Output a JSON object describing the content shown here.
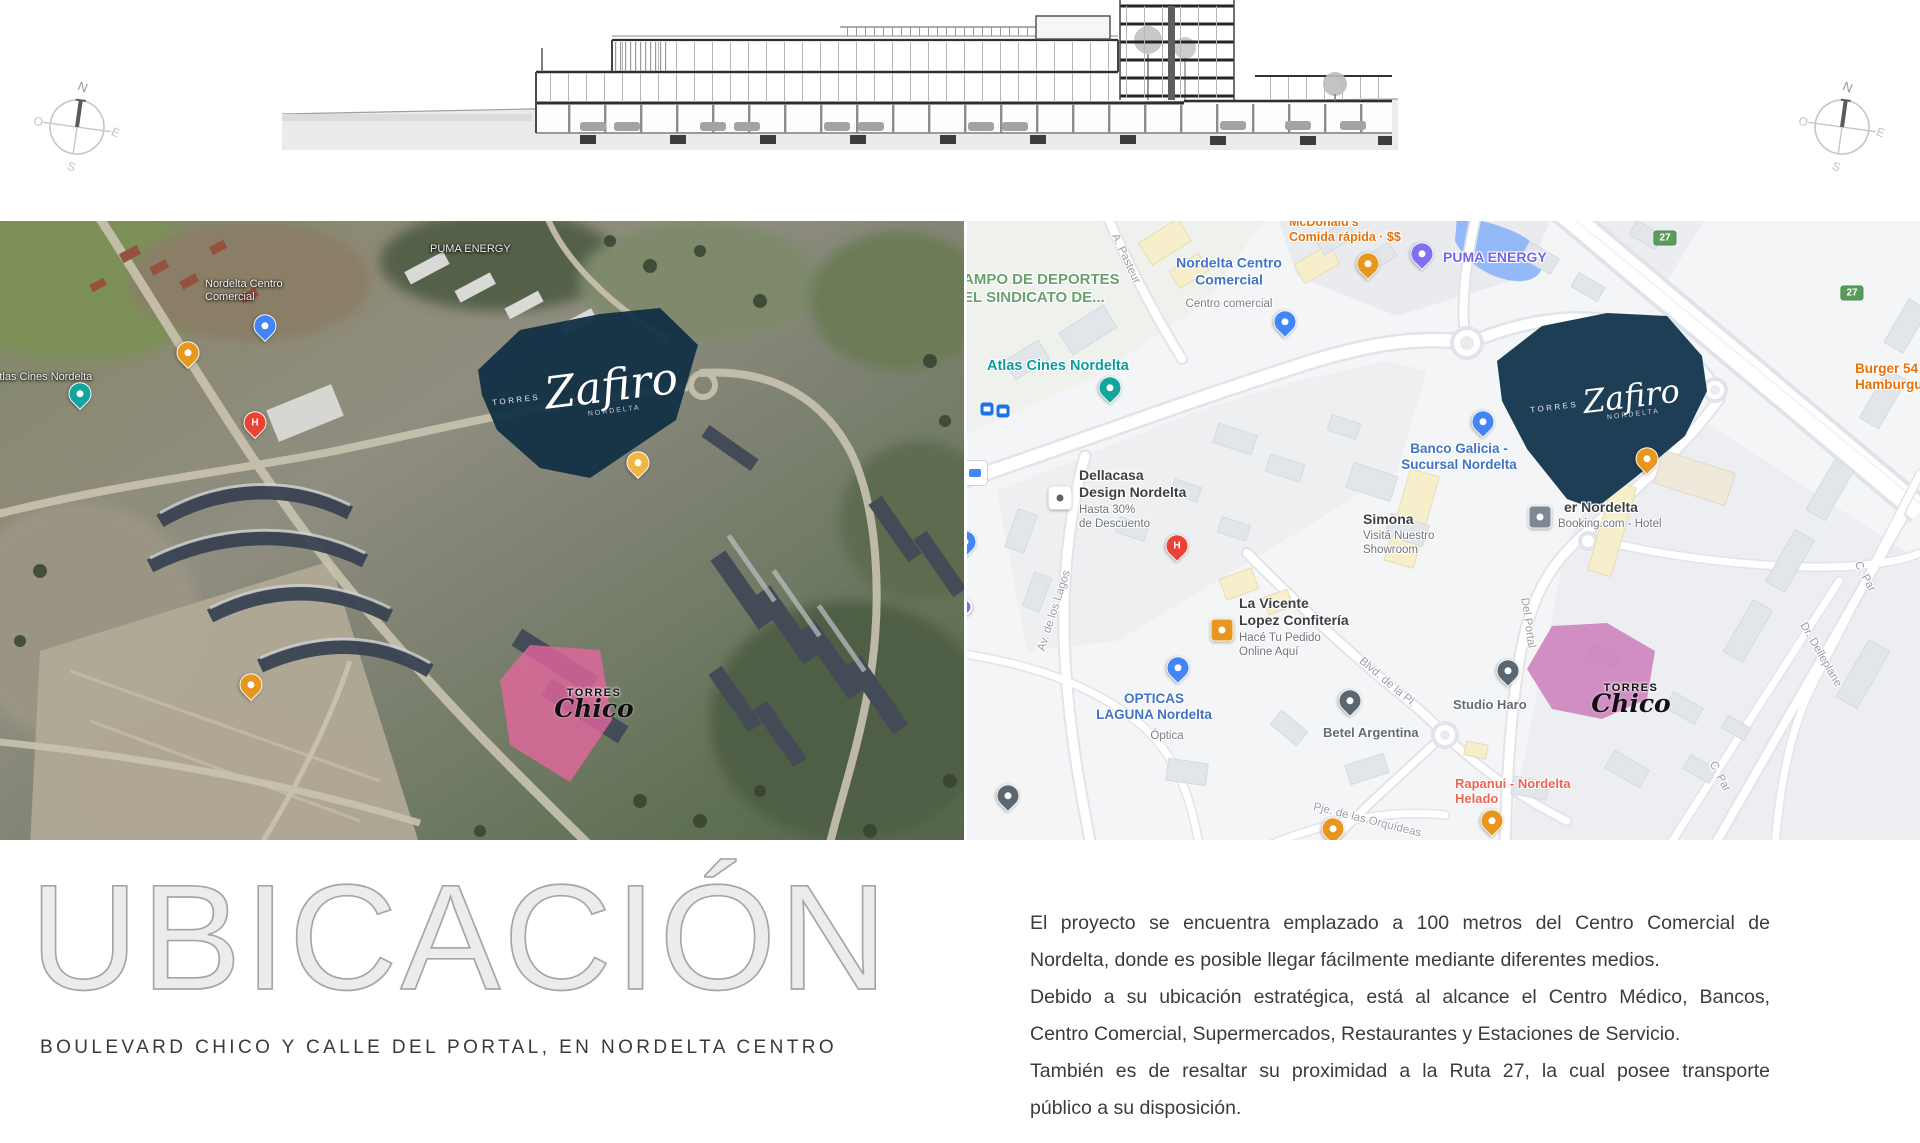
{
  "slide": {
    "title": "UBICACIÓN",
    "subtitle": "BOULEVARD CHICO Y CALLE DEL PORTAL, EN NORDELTA CENTRO",
    "paragraph_lines": [
      "El proyecto se encuentra emplazado a 100 metros del Centro Comercial de",
      "Nordelta, donde es posible llegar fácilmente mediante diferentes medios.",
      "Debido a su ubicación estratégica, está al alcance el Centro Médico, Bancos,",
      "Centro Comercial, Supermercados, Restaurantes y Estaciones de Servicio.",
      "También es de resaltar su proximidad a la Ruta 27, la cual posee transporte",
      "público a su disposición."
    ],
    "paragraph_justify": [
      true,
      false,
      true,
      false,
      true,
      false
    ]
  },
  "compass": {
    "n": "N",
    "e": "E",
    "s": "S",
    "o": "O"
  },
  "logos": {
    "zafiro": {
      "pre": "TORRES",
      "script": "Zafiro",
      "sub": "NORDELTA"
    },
    "torres": {
      "caps": "TORRES",
      "script": "Chico"
    }
  },
  "street_map": {
    "shields": [
      {
        "label": "27",
        "x": 698,
        "y": 17
      },
      {
        "label": "27",
        "x": 885,
        "y": 72
      }
    ],
    "labels": [
      {
        "lines": [
          "AMPO DE DEPORTES",
          "EL SINDICATO DE..."
        ],
        "x": -4,
        "y": 50,
        "size": 15,
        "w": 700,
        "color": "#68a06e"
      },
      {
        "lines": [
          "Atlas Cines Nordelta"
        ],
        "x": 20,
        "y": 137,
        "size": 14.5,
        "w": 700,
        "color": "#0d9c9c"
      },
      {
        "lines": [
          "Nordelta Centro",
          "Comercial"
        ],
        "x": 262,
        "y": 50,
        "c": true,
        "size": 14,
        "w": 700,
        "color": "#4273c4"
      },
      {
        "lines": [
          "Centro comercial"
        ],
        "x": 262,
        "y": 84,
        "c": true,
        "size": 11.5,
        "w": 400,
        "color": "#7c8187"
      },
      {
        "lines": [
          "McDonald's",
          "Comida rápida · $$"
        ],
        "x": 322,
        "y": -6,
        "size": 12.5,
        "w": 700,
        "color": "#e8710a"
      },
      {
        "lines": [
          "PUMA ENERGY"
        ],
        "x": 476,
        "y": 28,
        "size": 14,
        "w": 700,
        "color": "#7265e8"
      },
      {
        "lines": [
          "Banco Galicia -",
          "Sucursal Nordelta"
        ],
        "x": 492,
        "y": 236,
        "c": true,
        "size": 13.5,
        "w": 600,
        "color": "#4273c4"
      },
      {
        "lines": [
          "Simona"
        ],
        "x": 396,
        "y": 290,
        "size": 14,
        "w": 700,
        "color": "#3c4043"
      },
      {
        "lines": [
          "Visitá Nuestro",
          "Showroom"
        ],
        "x": 396,
        "y": 309,
        "size": 11.5,
        "w": 400,
        "color": "#70757a"
      },
      {
        "lines": [
          "er Nordelta"
        ],
        "x": 597,
        "y": 278,
        "size": 14,
        "w": 700,
        "color": "#3c4043"
      },
      {
        "lines": [
          "Booking.com - Hotel"
        ],
        "x": 591,
        "y": 297,
        "size": 11.5,
        "w": 400,
        "color": "#70757a"
      },
      {
        "lines": [
          "Dellacasa",
          "Design Nordelta"
        ],
        "x": 112,
        "y": 246,
        "size": 14,
        "w": 700,
        "color": "#3c4043"
      },
      {
        "lines": [
          "Hasta 30%",
          "de Descuento"
        ],
        "x": 112,
        "y": 283,
        "size": 11.5,
        "w": 400,
        "color": "#70757a"
      },
      {
        "lines": [
          "OPTICAS",
          "LAGUNA Nordelta"
        ],
        "x": 187,
        "y": 486,
        "c": true,
        "size": 13.5,
        "w": 700,
        "color": "#4273c4"
      },
      {
        "lines": [
          "Óptica"
        ],
        "x": 200,
        "y": 516,
        "c": true,
        "size": 11.5,
        "w": 400,
        "color": "#7c8187"
      },
      {
        "lines": [
          "La Vicente",
          "Lopez Confitería"
        ],
        "x": 272,
        "y": 374,
        "size": 14,
        "w": 700,
        "color": "#3c4043"
      },
      {
        "lines": [
          "Hacé Tu Pedido",
          "Online Aquí"
        ],
        "x": 272,
        "y": 411,
        "size": 11.5,
        "w": 400,
        "color": "#70757a"
      },
      {
        "lines": [
          "Betel Argentina"
        ],
        "x": 356,
        "y": 504,
        "size": 13,
        "w": 600,
        "color": "#646b73"
      },
      {
        "lines": [
          "Studio Haro"
        ],
        "x": 486,
        "y": 476,
        "size": 13,
        "w": 600,
        "color": "#646b73"
      },
      {
        "lines": [
          "Rapanui - Nordelta",
          "Helado"
        ],
        "x": 488,
        "y": 555,
        "size": 13,
        "w": 700,
        "color": "#ef6352"
      },
      {
        "lines": [
          "Burger 54",
          "Hamburguesa · $$"
        ],
        "x": 888,
        "y": 140,
        "size": 13.5,
        "w": 700,
        "color": "#e8710a"
      },
      {
        "lines": [
          "Av. de los Lagos"
        ],
        "x": 88,
        "y": 390,
        "c": true,
        "rot": -72,
        "size": 11.5,
        "w": 500,
        "color": "#9aa0a6"
      },
      {
        "lines": [
          "A. Pasteur"
        ],
        "x": 158,
        "y": 38,
        "c": true,
        "rot": 65,
        "size": 11.5,
        "w": 500,
        "color": "#9aa0a6"
      },
      {
        "lines": [
          "Blvd. de la Pl."
        ],
        "x": 420,
        "y": 462,
        "c": true,
        "rot": 40,
        "size": 11.5,
        "w": 500,
        "color": "#9aa0a6"
      },
      {
        "lines": [
          "Del Portal"
        ],
        "x": 560,
        "y": 402,
        "c": true,
        "rot": 82,
        "size": 11.5,
        "w": 500,
        "color": "#9aa0a6"
      },
      {
        "lines": [
          "Pje. de las Orquídeas"
        ],
        "x": 400,
        "y": 600,
        "c": true,
        "rot": 14,
        "size": 11.5,
        "w": 500,
        "color": "#9aa0a6"
      },
      {
        "lines": [
          "Dr. Delleplane"
        ],
        "x": 853,
        "y": 434,
        "c": true,
        "rot": 60,
        "size": 11.5,
        "w": 500,
        "color": "#9aa0a6"
      },
      {
        "lines": [
          "C. Par"
        ],
        "x": 752,
        "y": 556,
        "c": true,
        "rot": 62,
        "size": 11.5,
        "w": 500,
        "color": "#9aa0a6"
      },
      {
        "lines": [
          "C. Par"
        ],
        "x": 897,
        "y": 356,
        "c": true,
        "rot": 62,
        "size": 11.5,
        "w": 500,
        "color": "#9aa0a6"
      }
    ],
    "pins": [
      {
        "x": 143,
        "y": 176,
        "shape": "drop",
        "color": "#12a5a0",
        "name": "cinema-pin"
      },
      {
        "x": 318,
        "y": 110,
        "shape": "drop",
        "color": "#4285f4",
        "name": "shopping-pin"
      },
      {
        "x": 401,
        "y": 52,
        "shape": "drop",
        "color": "#e8971e",
        "name": "restaurant-pin"
      },
      {
        "x": 455,
        "y": 42,
        "shape": "drop",
        "color": "#7c71f2",
        "name": "fuel-pin"
      },
      {
        "x": 516,
        "y": 210,
        "shape": "drop",
        "color": "#4285f4",
        "name": "bank-pin"
      },
      {
        "x": 573,
        "y": 296,
        "shape": "square",
        "color": "#7e8794",
        "name": "hotel-pin"
      },
      {
        "x": 93,
        "y": 277,
        "shape": "square",
        "color": "#ffffff",
        "dot": "#5f6368",
        "name": "store-pin"
      },
      {
        "x": 211,
        "y": 456,
        "shape": "drop",
        "color": "#4285f4",
        "name": "optics-pin"
      },
      {
        "x": 255,
        "y": 409,
        "shape": "square",
        "color": "#e8971e",
        "name": "cafe-pin"
      },
      {
        "x": 383,
        "y": 489,
        "shape": "drop",
        "color": "#5b6770",
        "name": "betel-pin"
      },
      {
        "x": 541,
        "y": 459,
        "shape": "drop",
        "color": "#5b6770",
        "name": "studio-pin"
      },
      {
        "x": 525,
        "y": 609,
        "shape": "drop",
        "color": "#e8971e",
        "name": "icecream-pin"
      },
      {
        "x": 680,
        "y": 247,
        "shape": "drop",
        "color": "#e8971e",
        "name": "restaurant-pin"
      },
      {
        "x": 210,
        "y": 334,
        "shape": "drop",
        "color": "#ea4335",
        "glyph": "H",
        "name": "hospital-pin"
      },
      {
        "x": 41,
        "y": 584,
        "shape": "drop",
        "color": "#5b6770",
        "name": "place-pin"
      },
      {
        "x": 366,
        "y": 617,
        "shape": "drop",
        "color": "#e8971e",
        "name": "restaurant-pin"
      },
      {
        "x": -2,
        "y": 330,
        "shape": "drop",
        "color": "#4285f4",
        "name": "shop-pin"
      },
      {
        "x": -3,
        "y": 386,
        "shape": "circle",
        "color": "#7c71f2",
        "name": "poi-dot"
      },
      {
        "x": 20,
        "y": 188,
        "shape": "tsq",
        "color": "#1a73e8",
        "name": "bus-stop-icon"
      },
      {
        "x": 36,
        "y": 190,
        "shape": "tsq",
        "color": "#1a73e8",
        "name": "bus-stop-icon"
      },
      {
        "x": 8,
        "y": 252,
        "shape": "carsq",
        "color": "#ffffff",
        "name": "car-dealer-icon"
      }
    ]
  },
  "satellite_map": {
    "labels": [
      {
        "lines": [
          "Nordelta Centro",
          "Comercial"
        ],
        "x": 205,
        "y": 57,
        "size": 11,
        "w": 400,
        "color": "#f0f0ee"
      },
      {
        "lines": [
          "PUMA ENERGY"
        ],
        "x": 430,
        "y": 22,
        "size": 11,
        "w": 400,
        "color": "#eceeec"
      },
      {
        "lines": [
          "Atlas Cines Nordelta"
        ],
        "x": -8,
        "y": 150,
        "size": 11,
        "w": 400,
        "color": "#f0f0ee"
      }
    ],
    "pins": [
      {
        "x": 80,
        "y": 182,
        "shape": "drop",
        "color": "#12a5a0",
        "name": "cinema-pin"
      },
      {
        "x": 265,
        "y": 114,
        "shape": "drop",
        "color": "#4285f4",
        "name": "shopping-pin"
      },
      {
        "x": 188,
        "y": 141,
        "shape": "drop",
        "color": "#e8971e",
        "name": "restaurant-pin"
      },
      {
        "x": 638,
        "y": 251,
        "shape": "drop",
        "color": "#f0b643",
        "name": "poi-pin"
      },
      {
        "x": 255,
        "y": 211,
        "shape": "drop",
        "color": "#ea4335",
        "glyph": "H",
        "name": "hospital-pin"
      },
      {
        "x": 251,
        "y": 473,
        "shape": "drop",
        "color": "#e8971e",
        "name": "restaurant-pin"
      }
    ]
  }
}
